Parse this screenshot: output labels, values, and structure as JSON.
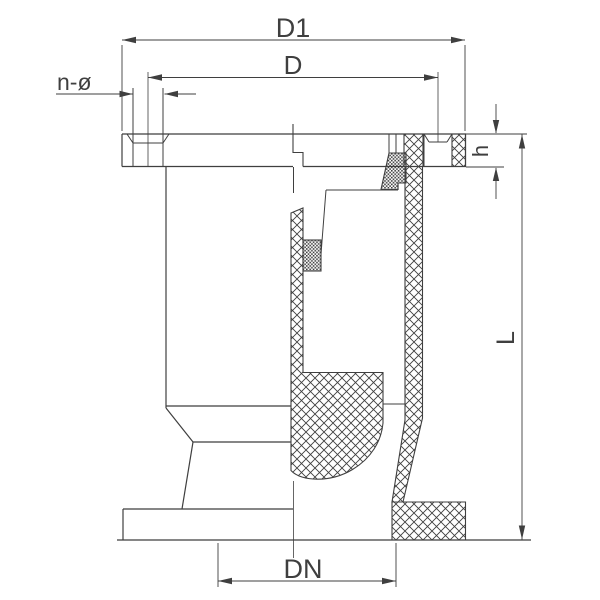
{
  "drawing": {
    "title": "flanged air release valve half-section drawing",
    "style": "2D CAD line drawing, left half outside view, right half cross-section with hatching",
    "colors": {
      "line": "#3f3f3f",
      "background": "#ffffff"
    },
    "hatch": {
      "section_metal": "cross-hatch",
      "seal_material": "fine-dot"
    }
  },
  "dimensions": {
    "d1": {
      "label": "D1"
    },
    "d": {
      "label": "D"
    },
    "n_phi": {
      "label": "n-ø"
    },
    "h": {
      "label": "h"
    },
    "l": {
      "label": "L"
    },
    "dn": {
      "label": "DN"
    }
  }
}
